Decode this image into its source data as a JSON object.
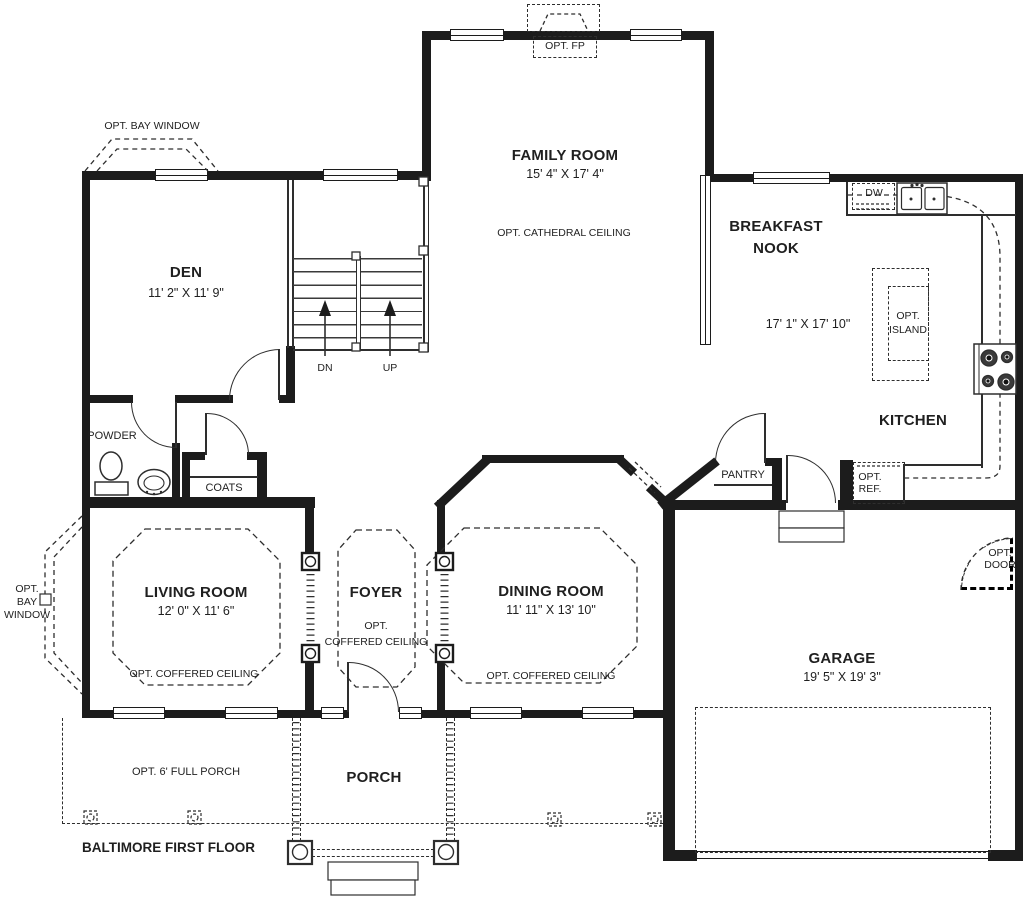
{
  "plan_title": "BALTIMORE FIRST FLOOR",
  "rooms": {
    "family_room": {
      "name": "FAMILY ROOM",
      "dims": "15' 4\" X 17' 4\"",
      "note": "OPT. CATHEDRAL CEILING"
    },
    "den": {
      "name": "DEN",
      "dims": "11' 2\" X 11' 9\""
    },
    "breakfast_nook": {
      "name_line1": "BREAKFAST",
      "name_line2": "NOOK",
      "dims": "17' 1\" X 17' 10\""
    },
    "kitchen": {
      "name": "KITCHEN"
    },
    "living_room": {
      "name": "LIVING ROOM",
      "dims": "12' 0\" X 11' 6\"",
      "note": "OPT. COFFERED CEILING"
    },
    "foyer": {
      "name": "FOYER",
      "note_line1": "OPT.",
      "note_line2": "COFFERED CEILING"
    },
    "dining_room": {
      "name": "DINING ROOM",
      "dims": "11' 11\" X 13' 10\"",
      "note": "OPT. COFFERED CEILING"
    },
    "garage": {
      "name": "GARAGE",
      "dims": "19' 5\" X 19' 3\""
    },
    "porch": {
      "name": "PORCH"
    },
    "powder_room": {
      "name": "POWDER"
    },
    "coats": {
      "name": "COATS"
    },
    "pantry": {
      "name": "PANTRY"
    }
  },
  "fixtures": {
    "fireplace": "OPT. FP",
    "bay_window_top": "OPT. BAY WINDOW",
    "bay_window_left_line1": "OPT.",
    "bay_window_left_line2": "BAY",
    "bay_window_left_line3": "WINDOW",
    "dishwasher": "DW",
    "island_line1": "OPT.",
    "island_line2": "ISLAND",
    "refrigerator_line1": "OPT.",
    "refrigerator_line2": "REF.",
    "opt_door_line1": "OPT.",
    "opt_door_line2": "DOOR",
    "full_porch": "OPT. 6' FULL PORCH",
    "stairs_down": "DN",
    "stairs_up": "UP"
  },
  "colors": {
    "wall": "#1c1c1c",
    "line": "#2e2e2e",
    "background": "#ffffff"
  }
}
